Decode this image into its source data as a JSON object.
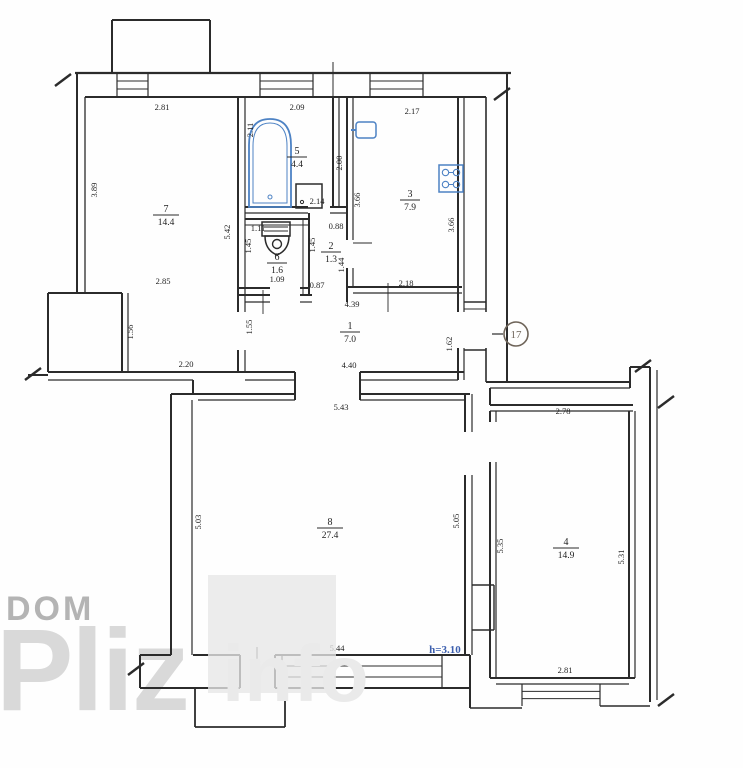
{
  "plan": {
    "unit_number": "17",
    "height_note": "h=3.10",
    "colors": {
      "ink": "#2b2b2b",
      "fixture_blue": "#4d82c4",
      "note_blue": "#3c5fae",
      "badge_brown": "#6e6459",
      "watermark_dom": "#b4b4b4",
      "watermark_pliz": "#d9d9d9",
      "watermark_info": "#eaeaea"
    },
    "rooms": [
      {
        "id": "room-7",
        "number": "7",
        "area": "14.4",
        "cx": 166,
        "cy": 215
      },
      {
        "id": "room-5",
        "number": "5",
        "area": "4.4",
        "cx": 297,
        "cy": 157
      },
      {
        "id": "room-6",
        "number": "6",
        "area": "1.6",
        "cx": 277,
        "cy": 263
      },
      {
        "id": "room-2",
        "number": "2",
        "area": "1.3",
        "cx": 331,
        "cy": 252
      },
      {
        "id": "room-3",
        "number": "3",
        "area": "7.9",
        "cx": 410,
        "cy": 200
      },
      {
        "id": "room-1",
        "number": "1",
        "area": "7.0",
        "cx": 350,
        "cy": 332
      },
      {
        "id": "room-8",
        "number": "8",
        "area": "27.4",
        "cx": 330,
        "cy": 528
      },
      {
        "id": "room-4",
        "number": "4",
        "area": "14.9",
        "cx": 566,
        "cy": 548
      }
    ],
    "dimensions": [
      {
        "t": "2.81",
        "x": 162,
        "y": 110,
        "r": 0
      },
      {
        "t": "2.09",
        "x": 297,
        "y": 110,
        "r": 0
      },
      {
        "t": "2.17",
        "x": 412,
        "y": 114,
        "r": 0
      },
      {
        "t": "2.11",
        "x": 253,
        "y": 130,
        "r": -90
      },
      {
        "t": "3.89",
        "x": 97,
        "y": 190,
        "r": -90
      },
      {
        "t": "5.42",
        "x": 230,
        "y": 232,
        "r": -90
      },
      {
        "t": "2.00",
        "x": 342,
        "y": 163,
        "r": -90
      },
      {
        "t": "3.66",
        "x": 360,
        "y": 200,
        "r": -90
      },
      {
        "t": "3.66",
        "x": 454,
        "y": 225,
        "r": -90
      },
      {
        "t": "2.14",
        "x": 317,
        "y": 204,
        "r": 0
      },
      {
        "t": "1.11",
        "x": 258,
        "y": 231,
        "r": 0
      },
      {
        "t": "0.88",
        "x": 336,
        "y": 229,
        "r": 0
      },
      {
        "t": "1.45",
        "x": 251,
        "y": 246,
        "r": -90
      },
      {
        "t": "1.45",
        "x": 315,
        "y": 245,
        "r": -90
      },
      {
        "t": "1.44",
        "x": 344,
        "y": 265,
        "r": -90
      },
      {
        "t": "1.09",
        "x": 277,
        "y": 282,
        "r": 0
      },
      {
        "t": "0.87",
        "x": 317,
        "y": 288,
        "r": 0
      },
      {
        "t": "2.18",
        "x": 406,
        "y": 286,
        "r": 0
      },
      {
        "t": "2.85",
        "x": 163,
        "y": 284,
        "r": 0
      },
      {
        "t": "4.39",
        "x": 352,
        "y": 307,
        "r": 0
      },
      {
        "t": "1.55",
        "x": 252,
        "y": 327,
        "r": -90
      },
      {
        "t": "1.62",
        "x": 452,
        "y": 344,
        "r": -90
      },
      {
        "t": "1.56",
        "x": 133,
        "y": 332,
        "r": -90
      },
      {
        "t": "2.20",
        "x": 186,
        "y": 367,
        "r": 0
      },
      {
        "t": "4.40",
        "x": 349,
        "y": 368,
        "r": 0
      },
      {
        "t": "5.43",
        "x": 341,
        "y": 410,
        "r": 0
      },
      {
        "t": "2.78",
        "x": 563,
        "y": 414,
        "r": 0
      },
      {
        "t": "5.03",
        "x": 201,
        "y": 522,
        "r": -90
      },
      {
        "t": "5.05",
        "x": 459,
        "y": 521,
        "r": -90
      },
      {
        "t": "5.35",
        "x": 503,
        "y": 546,
        "r": -90
      },
      {
        "t": "5.31",
        "x": 624,
        "y": 557,
        "r": -90
      },
      {
        "t": "5.44",
        "x": 337,
        "y": 651,
        "r": 0
      },
      {
        "t": "2.81",
        "x": 565,
        "y": 673,
        "r": 0
      }
    ],
    "watermark": {
      "dom": "DOM",
      "pliz": "Pliz",
      "info": "info"
    }
  }
}
